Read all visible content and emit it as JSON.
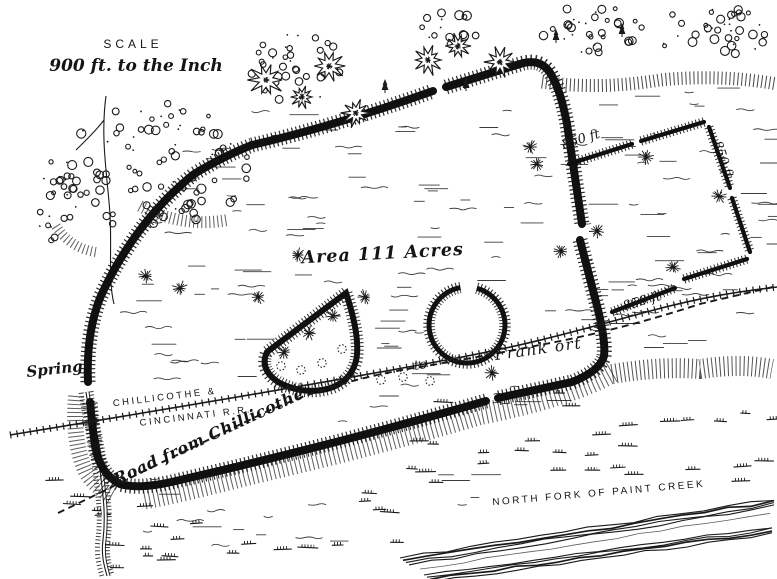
{
  "map": {
    "scale": {
      "heading": "SCALE",
      "ratio": "900 ft. to the Inch"
    },
    "enclosure": {
      "area_label": "Area 111 Acres"
    },
    "railroad": {
      "name_line1": "CHILLICOTHE &",
      "name_line2": "CINCINNATI R.R."
    },
    "road": {
      "label": "Road from Chillicothe",
      "to_label": "to",
      "destination_label": "Frank ort"
    },
    "spring": {
      "label": "Spring"
    },
    "creek": {
      "label": "NORTH FORK OF PAINT CREEK"
    },
    "measurements": {
      "square_north_wall": "850 ft",
      "square_east_wall": "850 ft.",
      "square_south_wall": "850 ft"
    }
  },
  "colors": {
    "ink": "#1a1a1a",
    "paper": "#ffffff"
  }
}
